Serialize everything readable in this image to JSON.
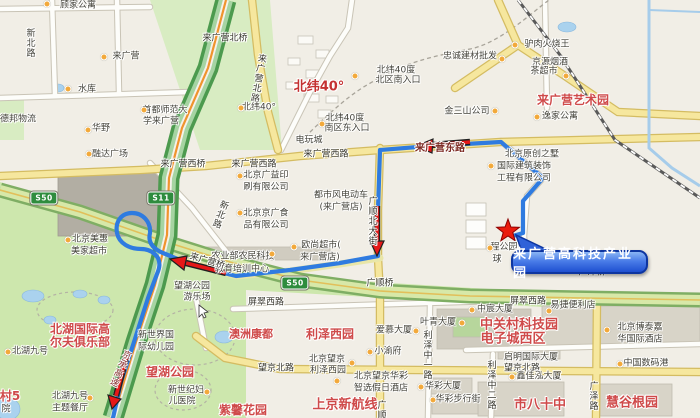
{
  "map": {
    "destination_callout": {
      "label": "来广营高科技产业园"
    },
    "colors": {
      "route": "#2f7be0",
      "arrow": "#e51818",
      "star": "#ea1c0d",
      "callout_border": "#0d35a0",
      "poi_dot": "#f2a93b",
      "expressway": "#4c9a4e"
    },
    "shields": [
      {
        "text": "S50",
        "x": 44,
        "y": 198
      },
      {
        "text": "S11",
        "x": 161,
        "y": 198
      },
      {
        "text": "S50",
        "x": 295,
        "y": 283
      }
    ],
    "labels": [
      {
        "t": "顾家公寓",
        "x": 78,
        "y": 6,
        "c": "poi"
      },
      {
        "t": "新北路",
        "x": 29,
        "y": 43,
        "c": "poi v"
      },
      {
        "t": "来广营",
        "x": 126,
        "y": 57,
        "c": "poi"
      },
      {
        "t": "水库",
        "x": 87,
        "y": 90,
        "c": "poi"
      },
      {
        "t": "德邦物流",
        "x": 18,
        "y": 120,
        "c": "poi"
      },
      {
        "t": "华野",
        "x": 101,
        "y": 129,
        "c": "poi"
      },
      {
        "t": "首都师范大",
        "x": 165,
        "y": 111,
        "c": "poi"
      },
      {
        "t": "学来广营",
        "x": 161,
        "y": 122,
        "c": "poi"
      },
      {
        "t": "来广营北桥",
        "x": 225,
        "y": 39,
        "c": "road"
      },
      {
        "t": "来广营北路",
        "x": 257,
        "y": 78,
        "c": "road v",
        "r": 10
      },
      {
        "t": "北纬40°",
        "x": 319,
        "y": 87,
        "c": "nw40"
      },
      {
        "t": "北纬40度",
        "x": 396,
        "y": 71,
        "c": "poi"
      },
      {
        "t": "北区南入口",
        "x": 398,
        "y": 81,
        "c": "poi"
      },
      {
        "t": "北纬40°",
        "x": 259,
        "y": 108,
        "c": "poi"
      },
      {
        "t": "北纬40度",
        "x": 345,
        "y": 119,
        "c": "poi"
      },
      {
        "t": "南区东入口",
        "x": 347,
        "y": 129,
        "c": "poi"
      },
      {
        "t": "忠诚建材批发",
        "x": 470,
        "y": 57,
        "c": "poi"
      },
      {
        "t": "驴肉火烧王",
        "x": 547,
        "y": 45,
        "c": "poi"
      },
      {
        "t": "京源烟酒",
        "x": 550,
        "y": 63,
        "c": "poi"
      },
      {
        "t": "茶超市",
        "x": 544,
        "y": 72,
        "c": "poi"
      },
      {
        "t": "金三山公司",
        "x": 467,
        "y": 112,
        "c": "poi"
      },
      {
        "t": "来广营艺术园",
        "x": 573,
        "y": 100,
        "c": "red12"
      },
      {
        "t": "逸家公寓",
        "x": 560,
        "y": 117,
        "c": "poi"
      },
      {
        "t": "融达广场",
        "x": 110,
        "y": 155,
        "c": "poi"
      },
      {
        "t": "来广营西桥",
        "x": 183,
        "y": 165,
        "c": "road"
      },
      {
        "t": "来广营西路",
        "x": 254,
        "y": 165,
        "c": "road"
      },
      {
        "t": "来广营西路",
        "x": 326,
        "y": 155,
        "c": "road"
      },
      {
        "t": "来广营东路",
        "x": 440,
        "y": 149,
        "c": "rroad"
      },
      {
        "t": "电玩城",
        "x": 309,
        "y": 141,
        "c": "poi"
      },
      {
        "t": "北京美惠",
        "x": 90,
        "y": 240,
        "c": "poi"
      },
      {
        "t": "美家超市",
        "x": 89,
        "y": 252,
        "c": "poi"
      },
      {
        "t": "新北路",
        "x": 219,
        "y": 214,
        "c": "road v",
        "r": 20
      },
      {
        "t": "北京广益印",
        "x": 266,
        "y": 176,
        "c": "poi"
      },
      {
        "t": "刷有限公司",
        "x": 266,
        "y": 188,
        "c": "poi"
      },
      {
        "t": "都市风电动车",
        "x": 341,
        "y": 196,
        "c": "poi"
      },
      {
        "t": "(来广营店)",
        "x": 341,
        "y": 208,
        "c": "poi"
      },
      {
        "t": "北京京广食",
        "x": 266,
        "y": 214,
        "c": "poi"
      },
      {
        "t": "品有限公司",
        "x": 266,
        "y": 226,
        "c": "poi"
      },
      {
        "t": "广顺北大街",
        "x": 371,
        "y": 221,
        "c": "road v"
      },
      {
        "t": "欧尚超市(",
        "x": 321,
        "y": 246,
        "c": "poi"
      },
      {
        "t": "来广营店)",
        "x": 320,
        "y": 258,
        "c": "poi"
      },
      {
        "t": "农业部农民科技",
        "x": 243,
        "y": 257,
        "c": "poi"
      },
      {
        "t": "教育培训中心",
        "x": 242,
        "y": 270,
        "c": "poi"
      },
      {
        "t": "北京原创之墅",
        "x": 532,
        "y": 155,
        "c": "poi"
      },
      {
        "t": "国际建筑装饰",
        "x": 524,
        "y": 167,
        "c": "poi"
      },
      {
        "t": "工程有限公司",
        "x": 524,
        "y": 179,
        "c": "poi"
      },
      {
        "t": "程公园",
        "x": 504,
        "y": 248,
        "c": "poi"
      },
      {
        "t": "球",
        "x": 497,
        "y": 260,
        "c": "poi"
      },
      {
        "t": "来广营桥",
        "x": 207,
        "y": 262,
        "c": "road",
        "r": 16
      },
      {
        "t": "广顺桥",
        "x": 380,
        "y": 284,
        "c": "road"
      },
      {
        "t": "广泽桥",
        "x": 592,
        "y": 273,
        "c": "road"
      },
      {
        "t": "京承高速",
        "x": 119,
        "y": 368,
        "c": "maroon v",
        "r": 24
      },
      {
        "t": "望湖公园",
        "x": 192,
        "y": 287,
        "c": "poi"
      },
      {
        "t": "游乐场",
        "x": 197,
        "y": 298,
        "c": "poi"
      },
      {
        "t": "北湖国际高",
        "x": 80,
        "y": 329,
        "c": "red12"
      },
      {
        "t": "尔夫俱乐部",
        "x": 80,
        "y": 342,
        "c": "red12"
      },
      {
        "t": "北湖九号",
        "x": 30,
        "y": 352,
        "c": "poi"
      },
      {
        "t": "新世界国",
        "x": 156,
        "y": 336,
        "c": "poi"
      },
      {
        "t": "际幼儿园",
        "x": 156,
        "y": 348,
        "c": "poi"
      },
      {
        "t": "望湖公园",
        "x": 170,
        "y": 372,
        "c": "red12"
      },
      {
        "t": "新世纪妇",
        "x": 186,
        "y": 391,
        "c": "poi"
      },
      {
        "t": "儿医院",
        "x": 182,
        "y": 402,
        "c": "poi"
      },
      {
        "t": "北湖九号",
        "x": 70,
        "y": 397,
        "c": "poi"
      },
      {
        "t": "主题餐厅",
        "x": 70,
        "y": 409,
        "c": "poi"
      },
      {
        "t": "村5",
        "x": 10,
        "y": 396,
        "c": "red12"
      },
      {
        "t": "院",
        "x": 6,
        "y": 410,
        "c": "poi"
      },
      {
        "t": "屏翠西路",
        "x": 266,
        "y": 303,
        "c": "road"
      },
      {
        "t": "屏翠西路",
        "x": 528,
        "y": 302,
        "c": "road"
      },
      {
        "t": "澳洲康都",
        "x": 251,
        "y": 334,
        "c": "red11"
      },
      {
        "t": "利泽西园",
        "x": 330,
        "y": 334,
        "c": "red12"
      },
      {
        "t": "爱慕大厦",
        "x": 394,
        "y": 331,
        "c": "poi"
      },
      {
        "t": "叶青大厦",
        "x": 438,
        "y": 323,
        "c": "poi"
      },
      {
        "t": "小渝府",
        "x": 388,
        "y": 352,
        "c": "poi"
      },
      {
        "t": "北京望京",
        "x": 327,
        "y": 360,
        "c": "poi"
      },
      {
        "t": "利泽西园",
        "x": 328,
        "y": 371,
        "c": "poi"
      },
      {
        "t": "望京北路",
        "x": 276,
        "y": 369,
        "c": "road"
      },
      {
        "t": "望京北路",
        "x": 522,
        "y": 369,
        "c": "road"
      },
      {
        "t": "利泽中一路",
        "x": 426,
        "y": 355,
        "c": "road v"
      },
      {
        "t": "北京望京华彩",
        "x": 381,
        "y": 377,
        "c": "poi"
      },
      {
        "t": "智选假日酒店",
        "x": 381,
        "y": 389,
        "c": "poi"
      },
      {
        "t": "华彩大厦",
        "x": 443,
        "y": 387,
        "c": "poi"
      },
      {
        "t": "华彩步行街",
        "x": 458,
        "y": 400,
        "c": "poi"
      },
      {
        "t": "上京新航线",
        "x": 345,
        "y": 405,
        "c": "red13"
      },
      {
        "t": "紫馨花园",
        "x": 243,
        "y": 410,
        "c": "red12"
      },
      {
        "t": "广顺",
        "x": 380,
        "y": 410,
        "c": "road v"
      },
      {
        "t": "中宸大厦",
        "x": 495,
        "y": 310,
        "c": "poi"
      },
      {
        "t": "易捷便利店",
        "x": 573,
        "y": 306,
        "c": "poi"
      },
      {
        "t": "中关村科技园",
        "x": 519,
        "y": 325,
        "c": "red13"
      },
      {
        "t": "电子城西区",
        "x": 513,
        "y": 339,
        "c": "red13"
      },
      {
        "t": "北京博泰嘉",
        "x": 640,
        "y": 328,
        "c": "poi"
      },
      {
        "t": "华国际酒店",
        "x": 640,
        "y": 340,
        "c": "poi"
      },
      {
        "t": "启明国际大厦",
        "x": 531,
        "y": 358,
        "c": "poi"
      },
      {
        "t": "中国数码港",
        "x": 646,
        "y": 364,
        "c": "poi"
      },
      {
        "t": "鑫佳泓大厦",
        "x": 539,
        "y": 377,
        "c": "poi"
      },
      {
        "t": "利泽中二路",
        "x": 490,
        "y": 385,
        "c": "road v"
      },
      {
        "t": "市八十中",
        "x": 540,
        "y": 405,
        "c": "red13"
      },
      {
        "t": "慧谷根园",
        "x": 632,
        "y": 403,
        "c": "red13"
      },
      {
        "t": "广泽路",
        "x": 592,
        "y": 396,
        "c": "road v"
      }
    ],
    "pois": [
      [
        47,
        4
      ],
      [
        104,
        57
      ],
      [
        68,
        89
      ],
      [
        88,
        130
      ],
      [
        144,
        110
      ],
      [
        241,
        108
      ],
      [
        355,
        76
      ],
      [
        322,
        124
      ],
      [
        502,
        59
      ],
      [
        515,
        45
      ],
      [
        566,
        76
      ],
      [
        495,
        111
      ],
      [
        537,
        117
      ],
      [
        89,
        154
      ],
      [
        68,
        240
      ],
      [
        240,
        176
      ],
      [
        240,
        213
      ],
      [
        294,
        247
      ],
      [
        272,
        254
      ],
      [
        491,
        166
      ],
      [
        490,
        248
      ],
      [
        8,
        352
      ],
      [
        90,
        398
      ],
      [
        207,
        392
      ],
      [
        416,
        331
      ],
      [
        462,
        323
      ],
      [
        370,
        352
      ],
      [
        352,
        363
      ],
      [
        337,
        381
      ],
      [
        421,
        387
      ],
      [
        433,
        400
      ],
      [
        472,
        310
      ],
      [
        549,
        311
      ],
      [
        607,
        330
      ],
      [
        620,
        364
      ],
      [
        512,
        377
      ]
    ]
  }
}
